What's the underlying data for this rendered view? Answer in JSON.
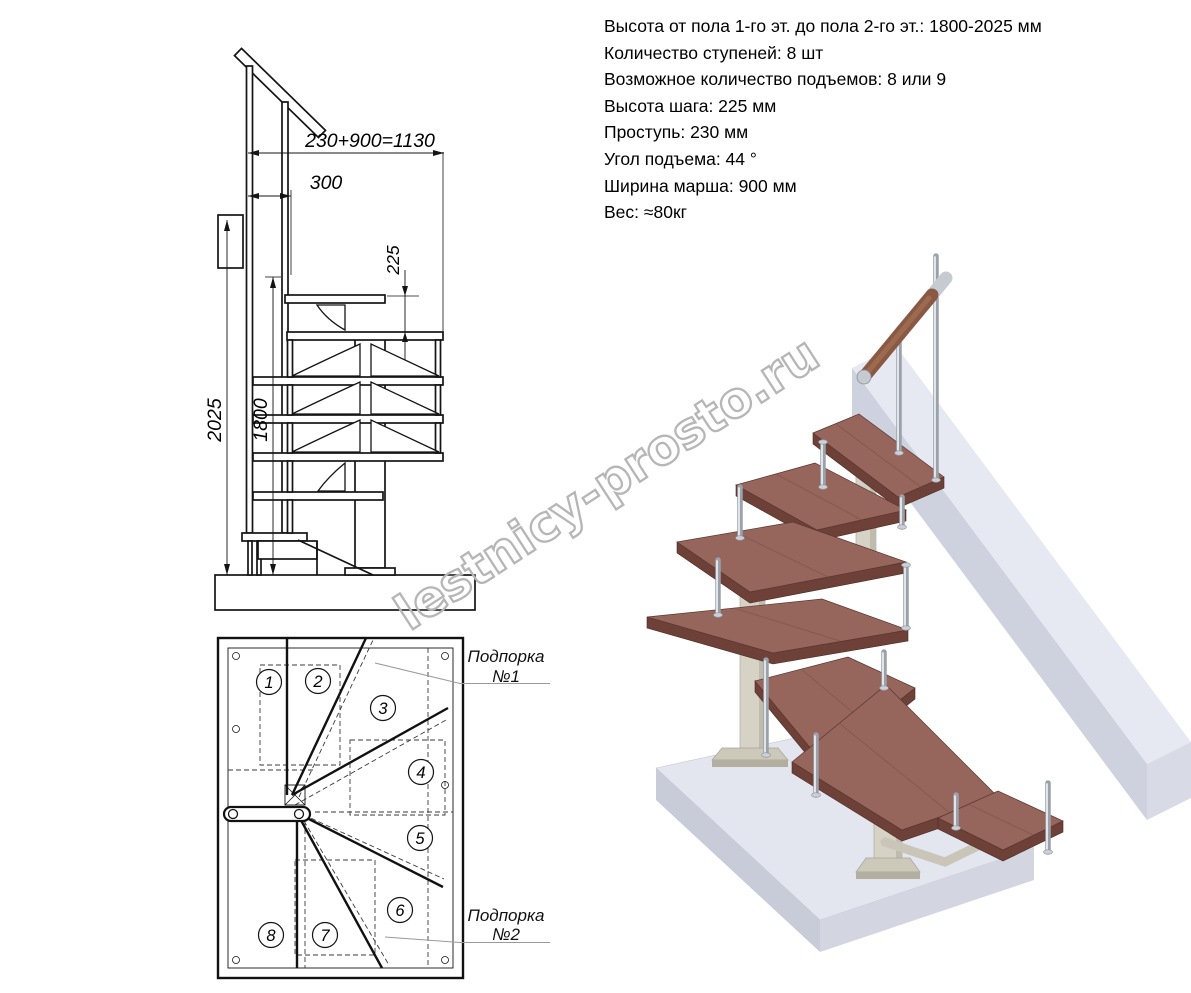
{
  "specs": {
    "lines": [
      "Высота от пола 1-го эт. до пола 2-го эт.: 1800-2025 мм",
      "Количество ступеней: 8 шт",
      "Возможное количество подъемов: 8 или 9",
      "Высота шага: 225 мм",
      "Проступь: 230 мм",
      "Угол подъема: 44 °",
      "Ширина марша: 900 мм",
      "Вес: ≈80кг"
    ]
  },
  "elevation": {
    "dims": {
      "total": "230+900=1130",
      "top_run": "300",
      "riser": "225",
      "height_max": "2025",
      "height_min": "1800"
    }
  },
  "plan": {
    "steps": [
      "1",
      "2",
      "3",
      "4",
      "5",
      "6",
      "7",
      "8"
    ],
    "supports": [
      {
        "line1": "Подпорка",
        "line2": "№1"
      },
      {
        "line1": "Подпорка",
        "line2": "№2"
      }
    ]
  },
  "watermark": "lestnicy-prosto.ru",
  "colors": {
    "wood_top": "#96655c",
    "wood_side": "#6d4138",
    "handrail_wood": "#8a5945",
    "metal": "#9ba1aa",
    "support_frame": "#d6d2c6",
    "slab_top": "#e3e5ef",
    "drawing_line": "#141414",
    "watermark_gray": "#b6b6b6"
  }
}
